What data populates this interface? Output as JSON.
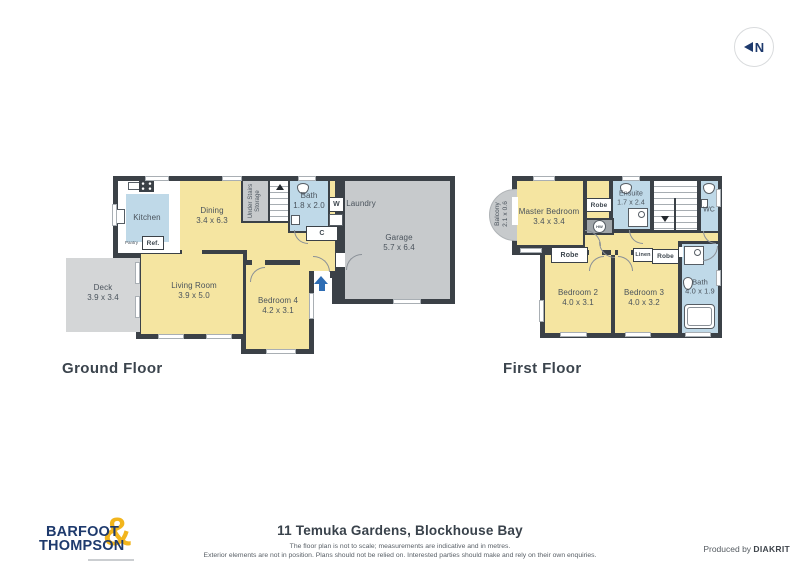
{
  "page": {
    "title": "11 Temuka Gardens, Blockhouse Bay",
    "disclaimer_line1": "The floor plan is not to scale; measurements are indicative and in metres.",
    "disclaimer_line2": "Exterior elements are not in position. Plans should not be relied on. Interested parties should make and rely on their own enquiries.",
    "produced_by": "Produced by ",
    "producer": "DIAKRIT",
    "compass": {
      "label": "N"
    }
  },
  "brand": {
    "line1": "BARFOOT",
    "line2": "THOMPSON",
    "ampersand": "&"
  },
  "colors": {
    "room_yellow": "#F5E5A1",
    "wet_area_blue": "#BFD9E8",
    "garage_gray": "#C7CACC",
    "deck_gray": "#D4D6D7",
    "wall_dark": "#3B4147",
    "brand_blue": "#1E3A6D",
    "brand_gold": "#F2B51D",
    "entry_arrow_blue": "#2E6DB4"
  },
  "ground_floor": {
    "label": "Ground Floor",
    "rooms": {
      "kitchen": {
        "name": "Kitchen"
      },
      "dining": {
        "name": "Dining",
        "dims": "3.4 x 6.3"
      },
      "storage": {
        "name": "Under Stairs Storage"
      },
      "bath": {
        "name": "Bath",
        "dims": "1.8 x 2.0"
      },
      "laundry": {
        "name": "Laundry"
      },
      "garage": {
        "name": "Garage",
        "dims": "5.7 x 6.4"
      },
      "deck": {
        "name": "Deck",
        "dims": "3.9 x 3.4"
      },
      "living": {
        "name": "Living Room",
        "dims": "3.9 x 5.0"
      },
      "bedroom4": {
        "name": "Bedroom 4",
        "dims": "4.2 x 3.1"
      }
    },
    "fixtures": {
      "pantry": "Pantry",
      "fridge": "Ref.",
      "washer": "W",
      "cupboard": "C"
    }
  },
  "first_floor": {
    "label": "First Floor",
    "rooms": {
      "balcony": {
        "name": "Balcony",
        "dims": "2.1 x 0.6"
      },
      "master": {
        "name": "Master Bedroom",
        "dims": "3.4 x 3.4"
      },
      "ensuite": {
        "name": "Ensuite",
        "dims": "1.7 x 2.4"
      },
      "wc": {
        "name": "WC"
      },
      "bedroom2": {
        "name": "Bedroom 2",
        "dims": "4.0 x 3.1"
      },
      "bedroom3": {
        "name": "Bedroom 3",
        "dims": "4.0 x 3.2"
      },
      "bath": {
        "name": "Bath",
        "dims": "4.0 x 1.9"
      }
    },
    "fixtures": {
      "robe_master": "Robe",
      "robe_bed2": "Robe",
      "robe_bed3": "Robe",
      "linen": "Linen",
      "hot_water": "HW"
    }
  }
}
